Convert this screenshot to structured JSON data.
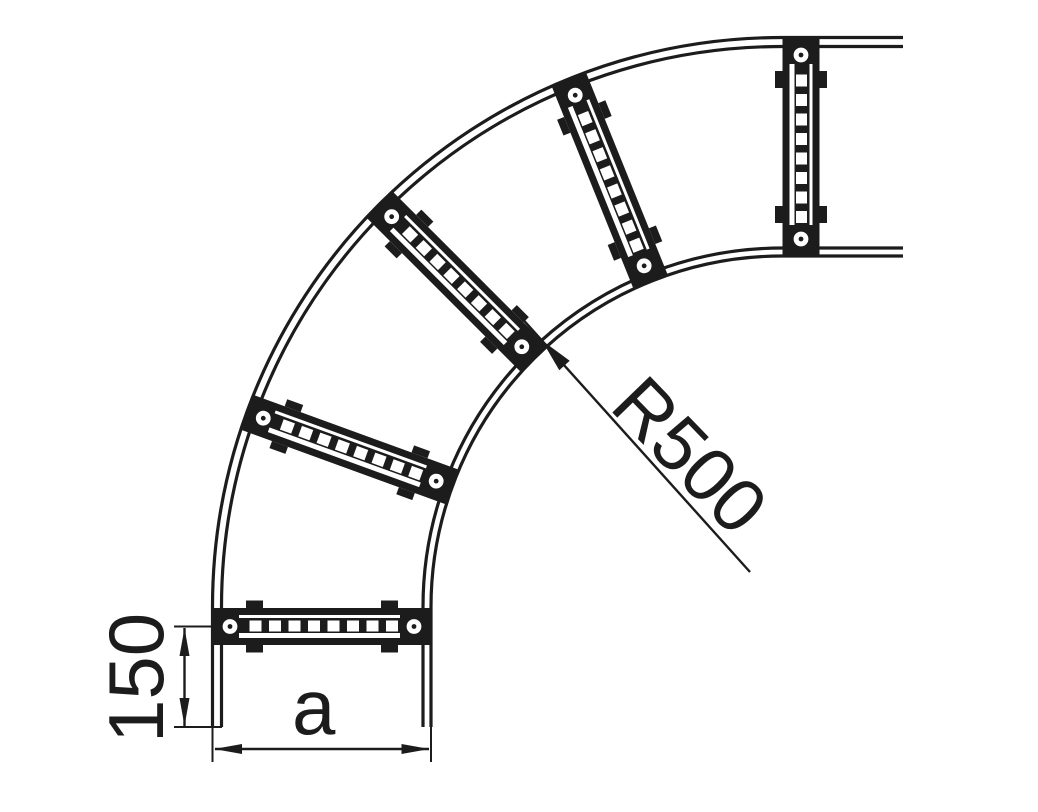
{
  "drawing": {
    "kind": "technical-line-drawing",
    "subject": "90-degree bend cable ladder, plan view",
    "ink_color": "#1c1c1c",
    "background_color": "#ffffff",
    "labels": {
      "radius": "R500",
      "end_spacing": "150",
      "width": "a"
    },
    "dimensions": [
      {
        "name": "bend-radius",
        "value": "R500",
        "type": "radius",
        "orientation": "diagonal-45deg"
      },
      {
        "name": "end-to-rung-spacing",
        "value": "150",
        "type": "linear",
        "orientation": "vertical"
      },
      {
        "name": "ladder-width",
        "value": "a",
        "type": "linear",
        "orientation": "horizontal"
      }
    ],
    "parts": {
      "rails": [
        "outer-rail-arc",
        "inner-rail-arc"
      ],
      "rung_count": 5,
      "rung_style": "perforated channel with slots, end bolt holes and side tabs"
    }
  }
}
